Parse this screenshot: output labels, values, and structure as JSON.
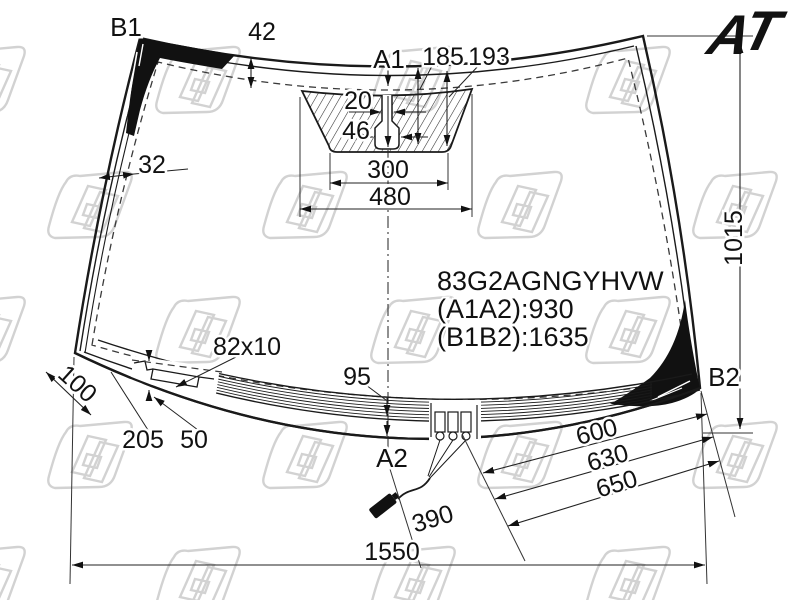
{
  "drawing": {
    "type": "windshield-technical-drawing",
    "part": {
      "number": "83G2AGNGYHVW",
      "dist_a": "(A1A2):930",
      "dist_b": "(B1B2):1635"
    },
    "refs": {
      "a1": "A1",
      "a2": "A2",
      "b1": "B1",
      "b2": "B2"
    },
    "dims": {
      "edge_band_top": "42",
      "edge_band_side": "32",
      "sensor_slot": "20",
      "sensor_bulb": "46",
      "sensor_width_inner": "300",
      "sensor_width_outer": "480",
      "sensor_depth_a": "185",
      "sensor_depth_b": "193",
      "glass_height": "1015",
      "bracket_size": "82x10",
      "band_bottom": "95",
      "corner_offset": "100",
      "bracket_pos_a": "205",
      "bracket_pos_b": "50",
      "terminal_a": "600",
      "terminal_b": "630",
      "terminal_c": "650",
      "wire": "390",
      "glass_width": "1550"
    },
    "logo": {
      "a": "A",
      "t": "T",
      "orange": "#e87b1e",
      "blue": "#272e9f"
    },
    "colors": {
      "line": "#1a1a1a",
      "watermark": "#d2d2d2"
    }
  }
}
